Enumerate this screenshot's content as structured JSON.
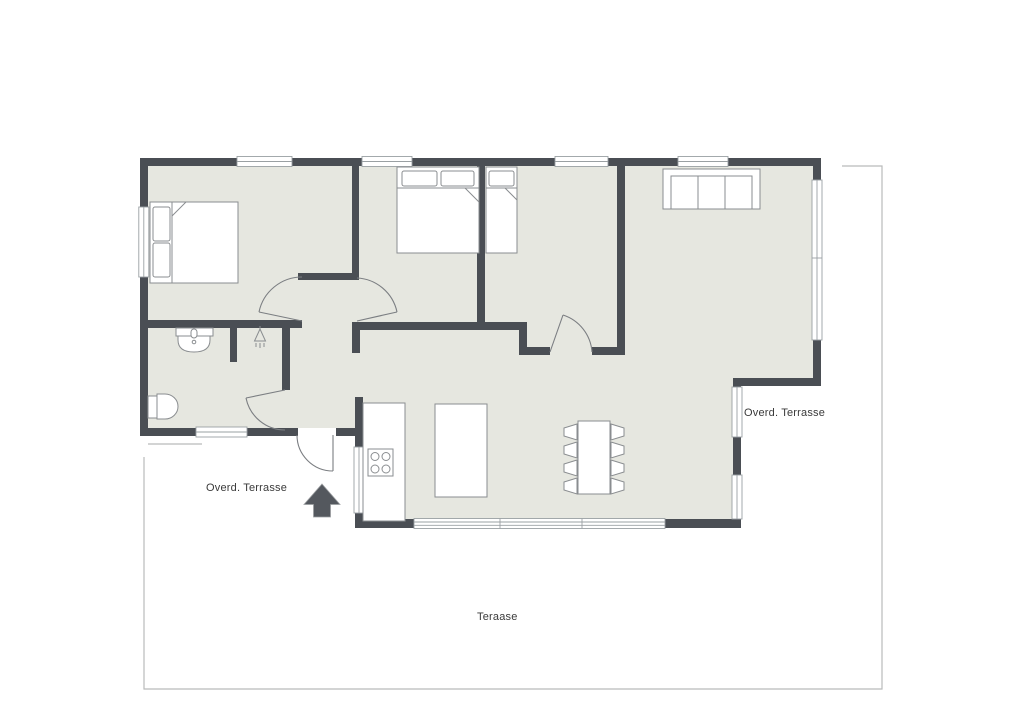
{
  "labels": {
    "terrace_left": "Overd. Terrasse",
    "terrace_right": "Overd. Terrasse",
    "terrace_bottom": "Teraase"
  },
  "colors": {
    "wall": "#4a4e54",
    "floor": "#e6e7e0",
    "furniture_stroke": "#8a8d90",
    "window_line": "#9aa0a3",
    "door_line": "#7b7e82",
    "terrace_outline": "#b9bbbb",
    "label_text": "#3a3a3a",
    "arrow": "#54585e",
    "background": "#ffffff"
  },
  "furniture_icons": [
    "double-bed-icon",
    "double-bed-icon",
    "single-bed-icon",
    "sofa-icon",
    "kitchen-counter-icon",
    "stove-icon",
    "kitchen-island-icon",
    "dining-table-icon",
    "dining-chair-icon",
    "toilet-icon",
    "sink-icon",
    "shower-head-icon",
    "entrance-arrow-icon"
  ]
}
